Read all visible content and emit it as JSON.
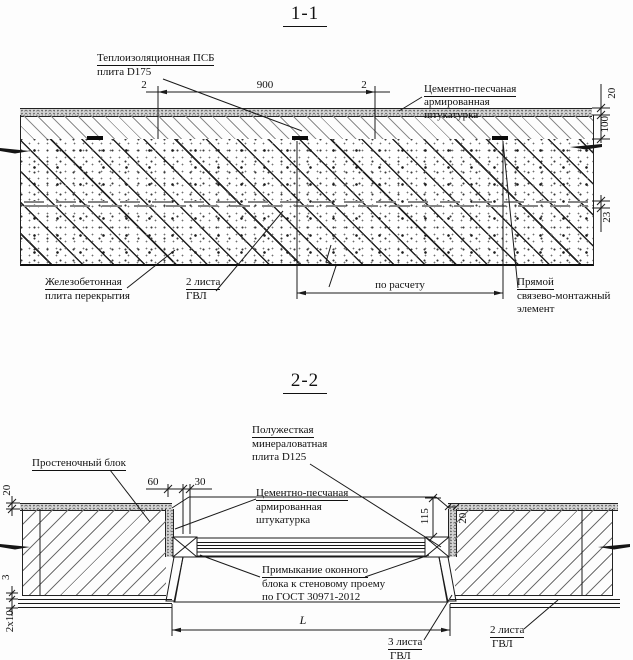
{
  "s1": {
    "title": "1-1",
    "insulation_label_1": "Теплоизоляционная ПСБ",
    "insulation_label_2": "плита D175",
    "plaster_label_1": "Цементно-песчаная",
    "plaster_label_2": "армированная",
    "plaster_label_3": "штукатурка",
    "dim_gap_left": "2",
    "dim_width": "900",
    "dim_gap_right": "2",
    "dim_plaster": "20",
    "dim_insulation": "100",
    "dim_gvl": "23",
    "slab_label_1": "Железобетонная",
    "slab_label_2": "плита перекрытия",
    "gvl_label_1": "2 листа",
    "gvl_label_2": "ГВЛ",
    "dim_spacing": "по расчету",
    "anchor_label_1": "Прямой",
    "anchor_label_2": "связево-монтажный",
    "anchor_label_3": "элемент"
  },
  "s2": {
    "title": "2-2",
    "minwool_label_1": "Полужесткая",
    "minwool_label_2": "минераловатная",
    "minwool_label_3": "плита D125",
    "pier_label": "Простеночный блок",
    "plaster_label_1": "Цементно-песчаная",
    "plaster_label_2": "армированная",
    "plaster_label_3": "штукатурка",
    "dim_60": "60",
    "dim_30": "30",
    "dim_115": "115",
    "dim_20_left": "20",
    "dim_20_right": "20",
    "dim_3": "3",
    "dim_2x10": "2x10",
    "joint_label_1": "Примыкание оконного",
    "joint_label_2": "блока к стеновому проему",
    "joint_label_3": "по ГОСТ 30971-2012",
    "dim_L": "L",
    "gvl3_label_1": "3 листа",
    "gvl3_label_2": "ГВЛ",
    "gvl2_label_1": "2 листа",
    "gvl2_label_2": "ГВЛ"
  },
  "colors": {
    "line": "#1a1a1a",
    "hatch": "#6f6f6f",
    "stipple_bg": "#d4d4d4"
  }
}
